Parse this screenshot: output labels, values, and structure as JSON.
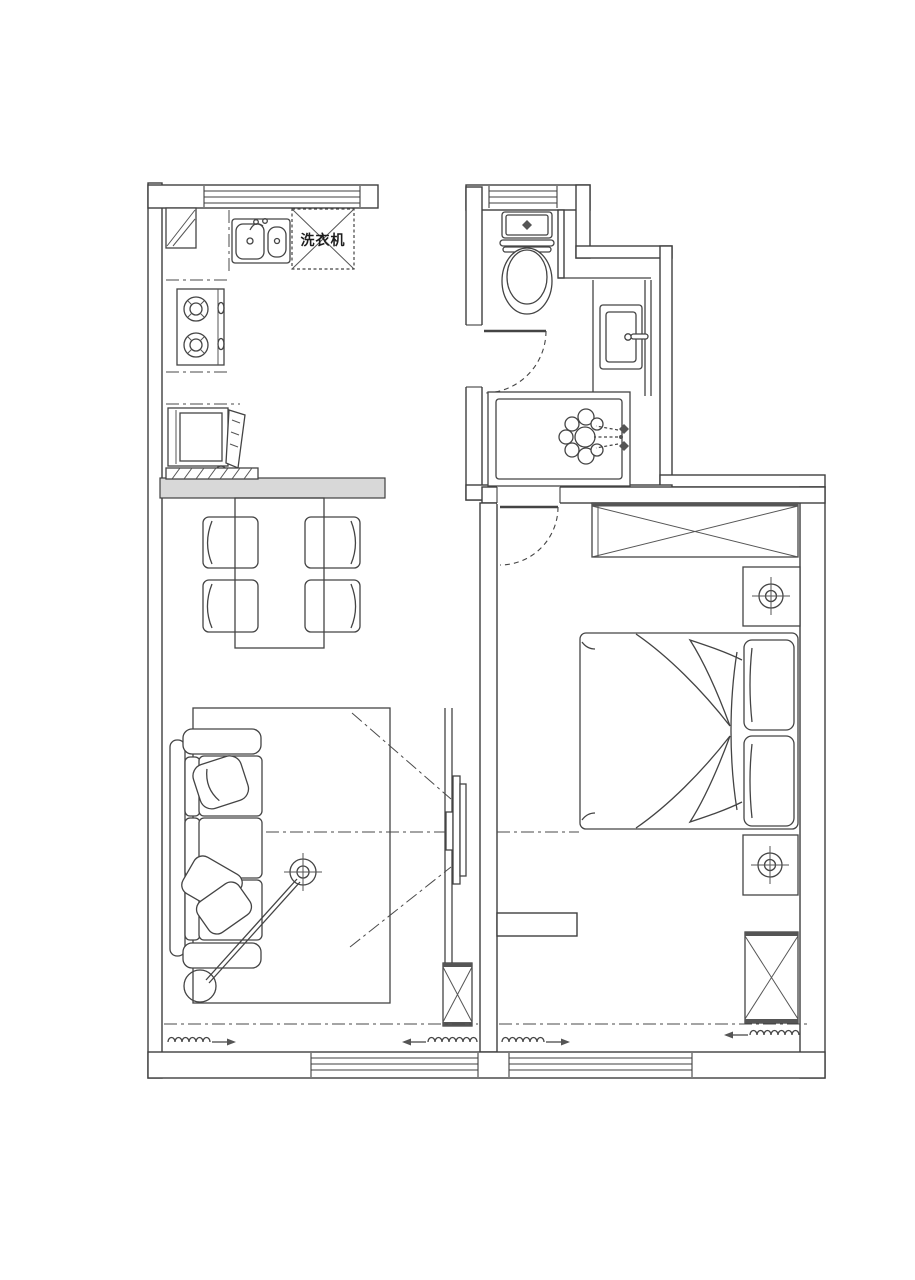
{
  "title": "apartment-floor-plan",
  "labels": {
    "washing_machine": "洗衣机"
  },
  "colors": {
    "background": "#ffffff",
    "line": "#3f3f3f",
    "wall_fill": "#ffffff",
    "dark_band": "#555555",
    "divider_wall": "#d8d8d8"
  },
  "plan": {
    "kitchen": {
      "fixtures": [
        "corner-cabinet",
        "double-sink",
        "washing-machine",
        "gas-stove-2-burner",
        "refrigerator",
        "counter",
        "window"
      ]
    },
    "bathroom": {
      "fixtures": [
        "toilet",
        "vanity-sink",
        "bathtub",
        "shower-spray",
        "swing-door",
        "window"
      ]
    },
    "dining_area": {
      "table_count": 1,
      "chair_count": 4
    },
    "living_room": {
      "fixtures": [
        "three-seat-sofa",
        "throw-pillows",
        "round-side-table",
        "floor-lamp",
        "rug",
        "wall-tv",
        "column",
        "radiator",
        "radiator",
        "window",
        "sight-lines"
      ]
    },
    "bedroom": {
      "fixtures": [
        "double-bed",
        "pillow",
        "pillow",
        "wardrobe-top",
        "wardrobe-corner",
        "nightstand",
        "nightstand",
        "ceiling-lamp",
        "ceiling-lamp",
        "swing-door",
        "radiator",
        "radiator",
        "window"
      ]
    },
    "radiator_count": 4,
    "lamp_symbol_count": 3
  }
}
